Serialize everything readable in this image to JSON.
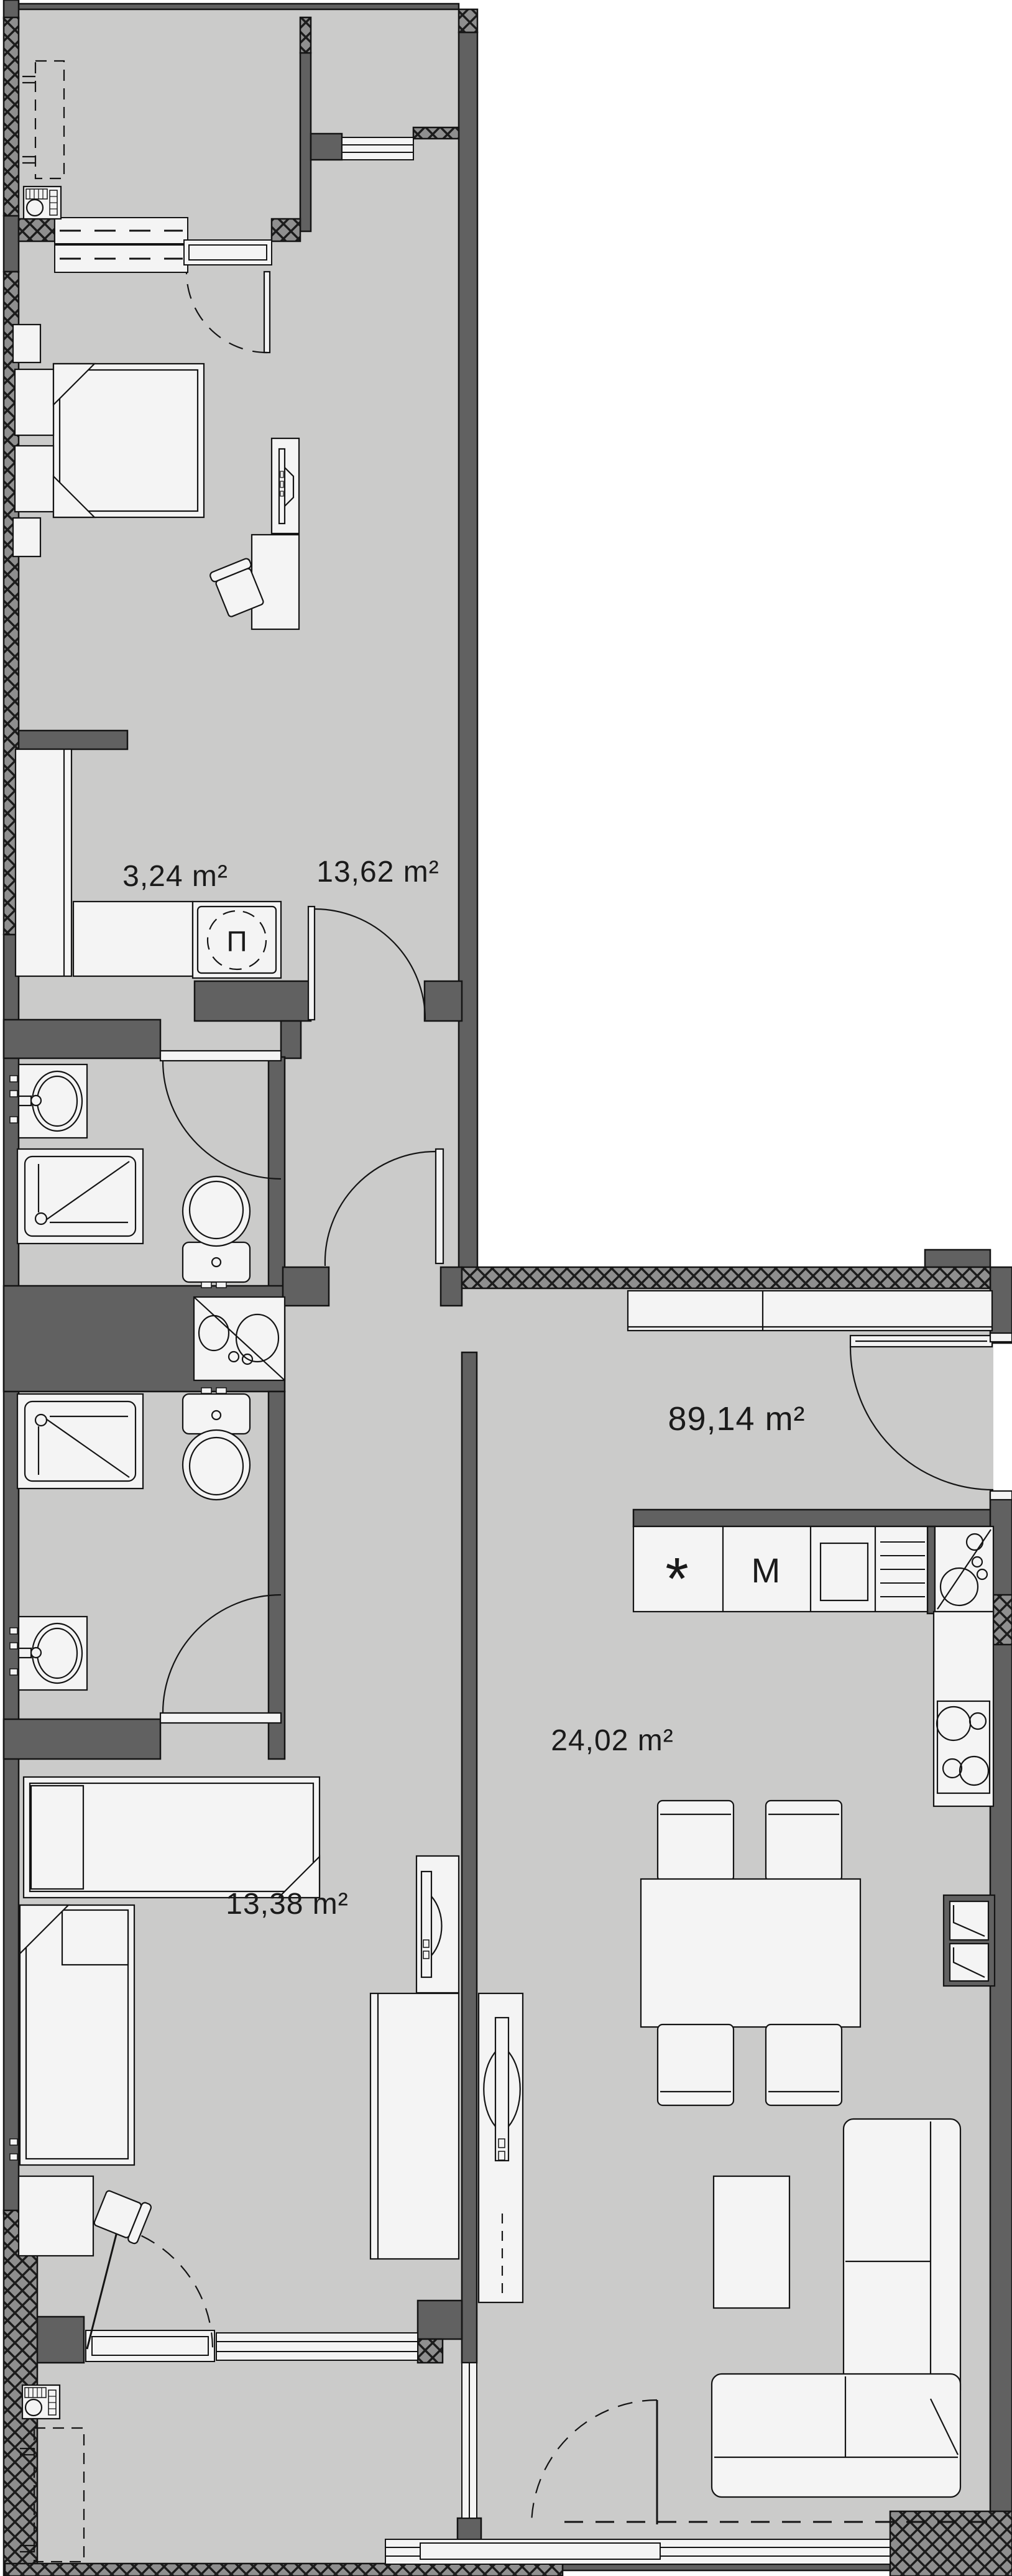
{
  "floorplan": {
    "total_area": {
      "label": "89,14 m²"
    },
    "rooms": [
      {
        "name": "walk-in-closet",
        "area_label": "3,24 m²"
      },
      {
        "name": "bedroom-1",
        "area_label": "13,62 m²"
      },
      {
        "name": "bedroom-2",
        "area_label": "13,38 m²"
      },
      {
        "name": "kitchen-dining",
        "area_label": "24,02 m²"
      }
    ],
    "appliance_symbols": {
      "washing_machine": "П",
      "fridge": "*",
      "oven": "M"
    },
    "colors": {
      "background": "#ffffff",
      "floor": "#cbcbca",
      "wall": "#616161",
      "hatch_background": "#8f8f8f",
      "outline": "#141414",
      "furniture": "#f4f4f4",
      "text": "#1a1a1a"
    }
  }
}
